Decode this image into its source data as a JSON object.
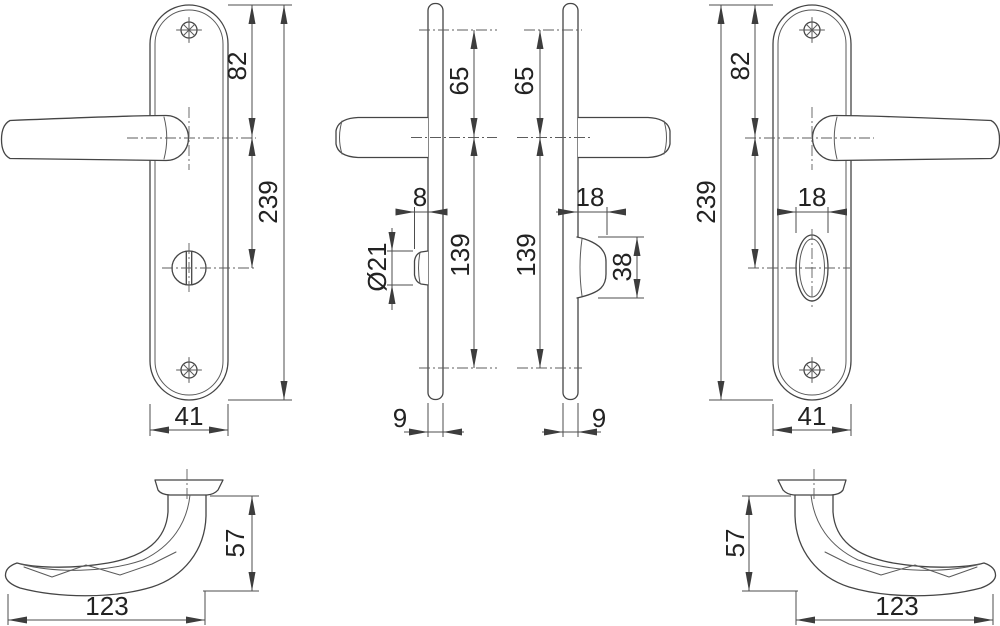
{
  "drawing": {
    "background": "#ffffff",
    "line_color": "#454545",
    "dimension_color": "#4d4d4d",
    "text_color": "#222222",
    "labels": {
      "front_left": {
        "top_to_handle": "82",
        "plate_height": "239",
        "plate_width": "41"
      },
      "side_left": {
        "screw_to_handle": "65",
        "turn_protrusion": "8",
        "turn_diameter": "Ø21",
        "handle_to_screw": "139",
        "plate_thickness": "9"
      },
      "side_right": {
        "screw_to_handle": "65",
        "turn_protrusion": "18",
        "turn_grip_height": "38",
        "handle_to_screw": "139",
        "plate_thickness": "9"
      },
      "front_right": {
        "top_to_handle": "82",
        "plate_height": "239",
        "oval_width": "18",
        "plate_width": "41"
      },
      "profile_left": {
        "handle_height": "57",
        "handle_length": "123"
      },
      "profile_right": {
        "handle_height": "57",
        "handle_length": "123"
      }
    }
  }
}
